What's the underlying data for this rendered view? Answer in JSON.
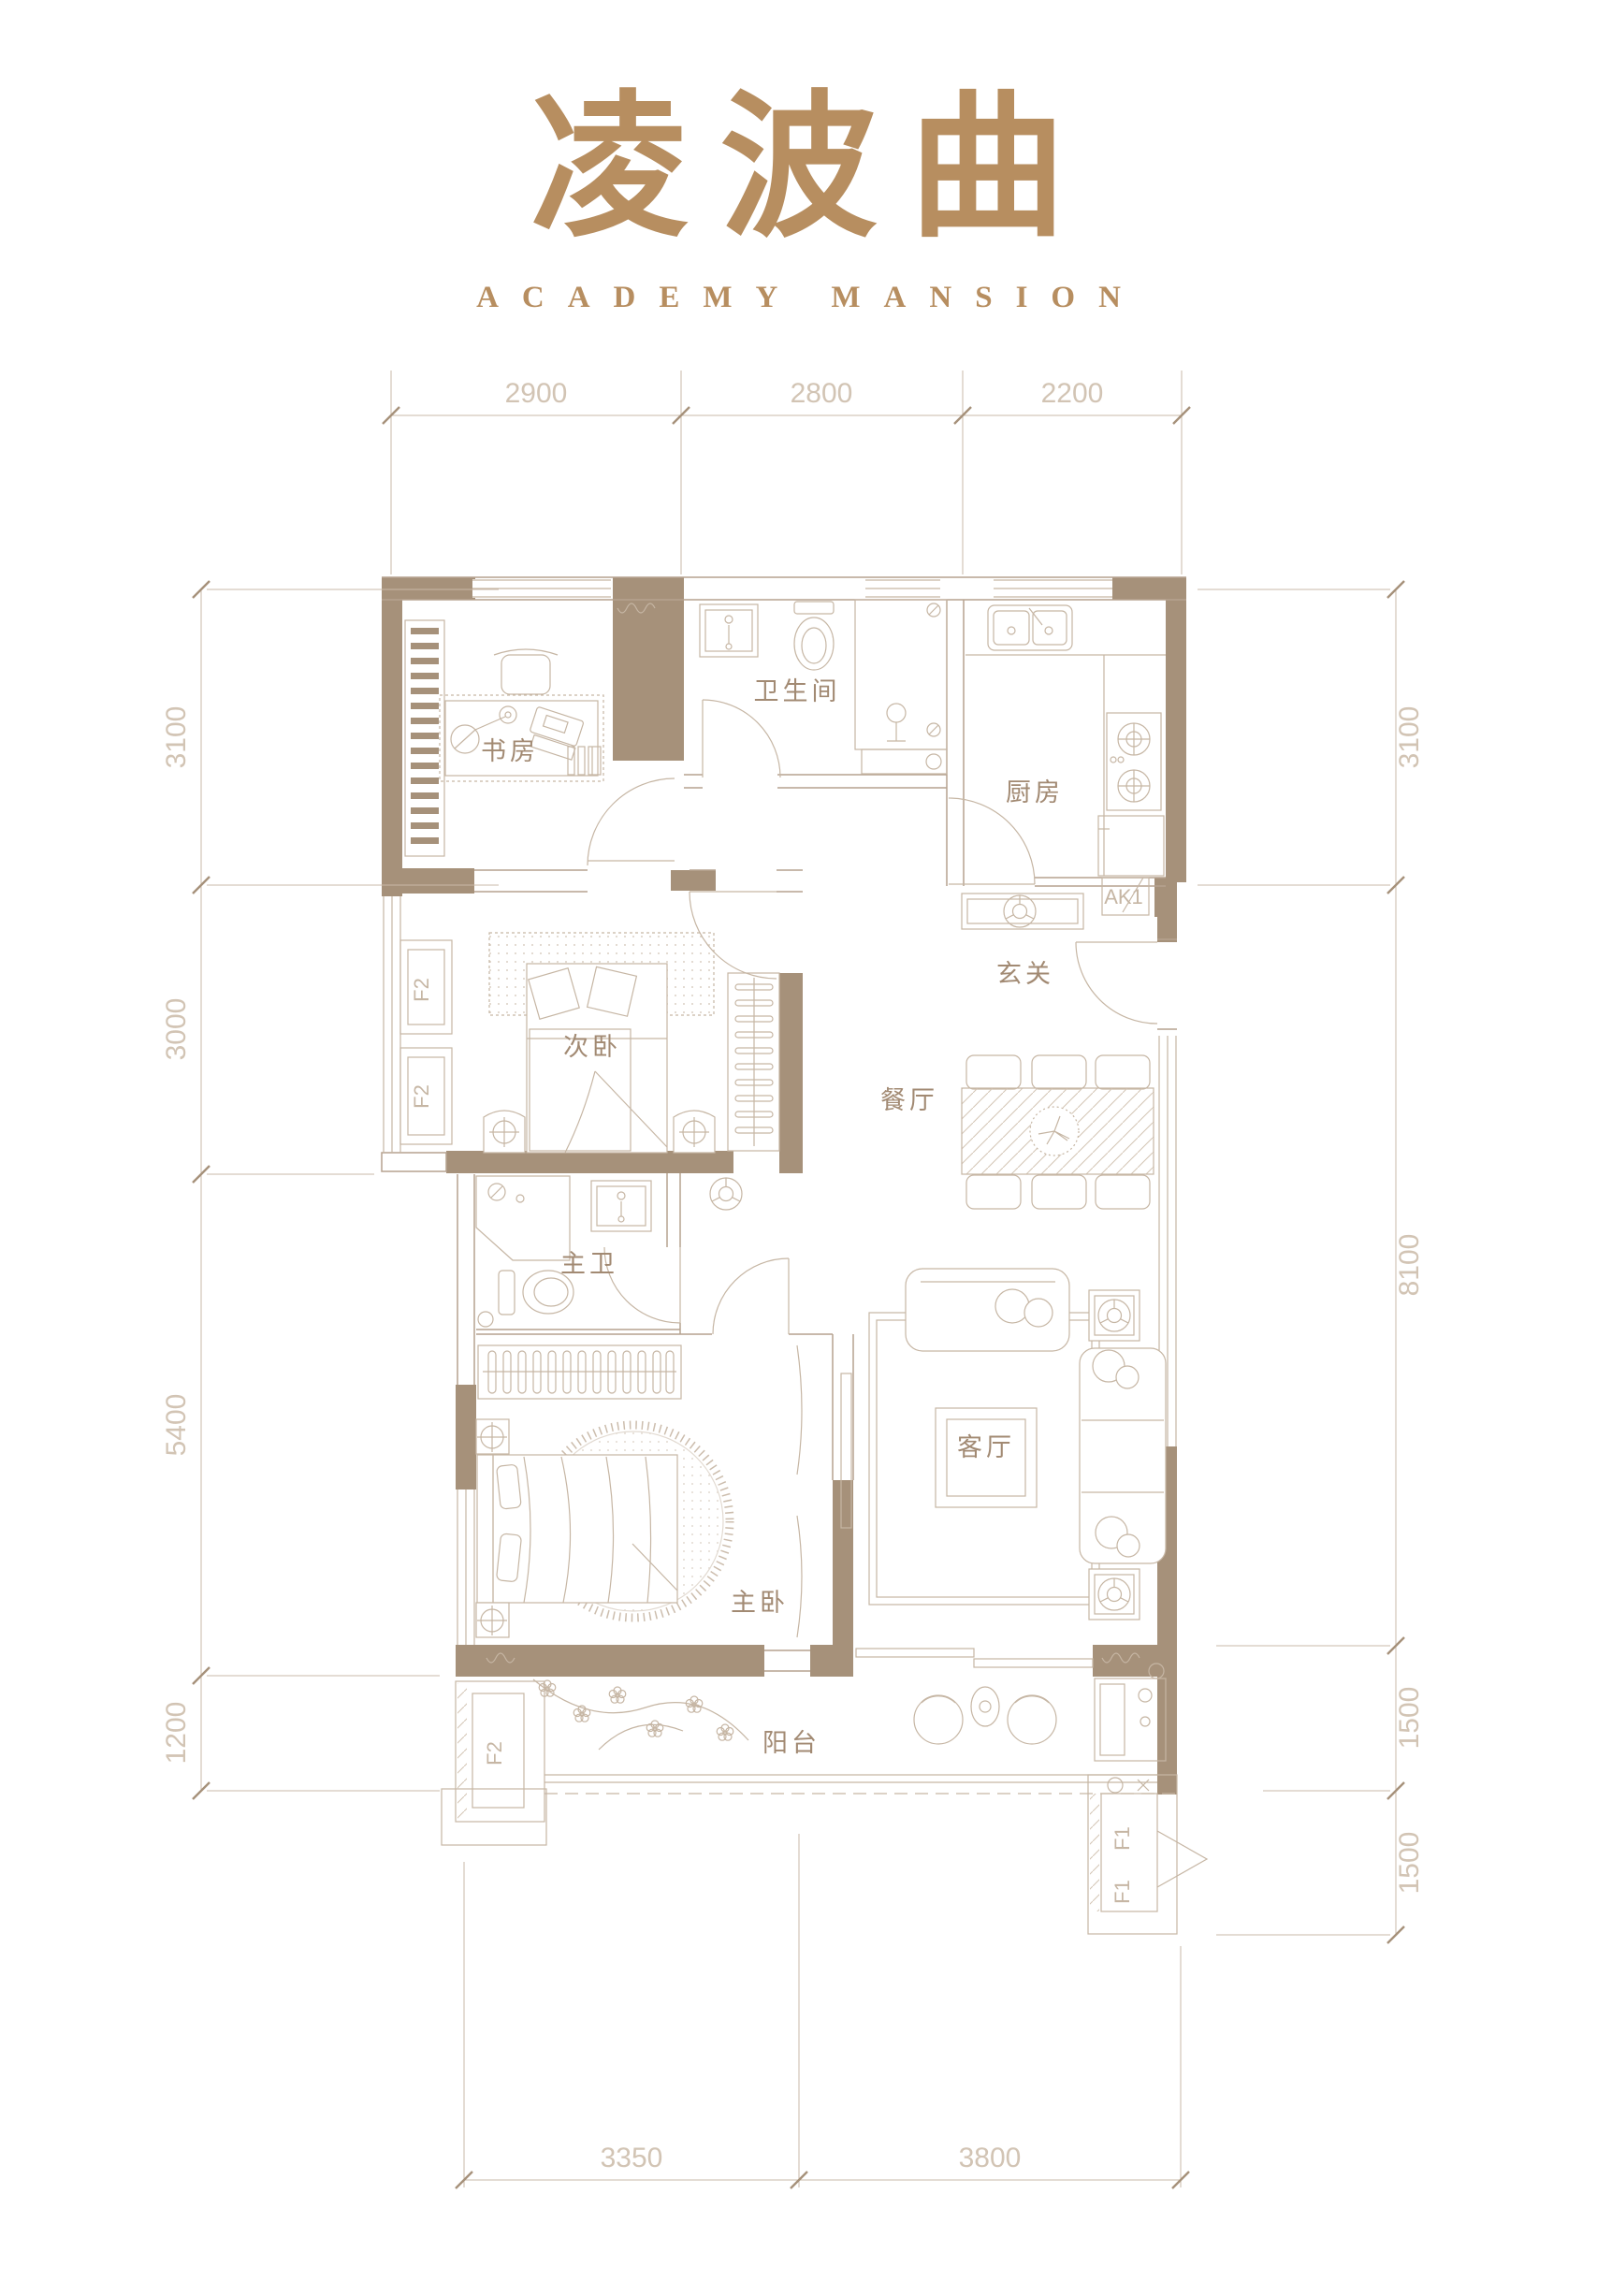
{
  "title": {
    "chinese": "凌波曲",
    "english": "ACADEMY MANSION"
  },
  "colors": {
    "accent": "#b78e60",
    "wall": "#a6917a",
    "thin_line": "#b5a28f",
    "furniture_line": "#c6b6a4",
    "dim_text": "#d2c4b4",
    "room_label": "#a28a73",
    "background": "#ffffff"
  },
  "rooms": {
    "study": "书房",
    "bathroom": "卫生间",
    "kitchen": "厨房",
    "second_bedroom": "次卧",
    "entry": "玄关",
    "dining": "餐厅",
    "master_bath": "主卫",
    "living": "客厅",
    "master_bedroom": "主卧",
    "balcony": "阳台"
  },
  "units": {
    "ak1": "AK1",
    "f2_bay_upper": "F2",
    "f2_bay_lower": "F2",
    "f2_balcony": "F2",
    "f1_upper": "F1",
    "f1_lower": "F1"
  },
  "dimensions": {
    "top": [
      "2900",
      "2800",
      "2200"
    ],
    "bottom": [
      "3350",
      "3800"
    ],
    "left": [
      "3100",
      "3000",
      "5400",
      "1200"
    ],
    "right": [
      "3100",
      "8100",
      "1500",
      "1500"
    ]
  }
}
